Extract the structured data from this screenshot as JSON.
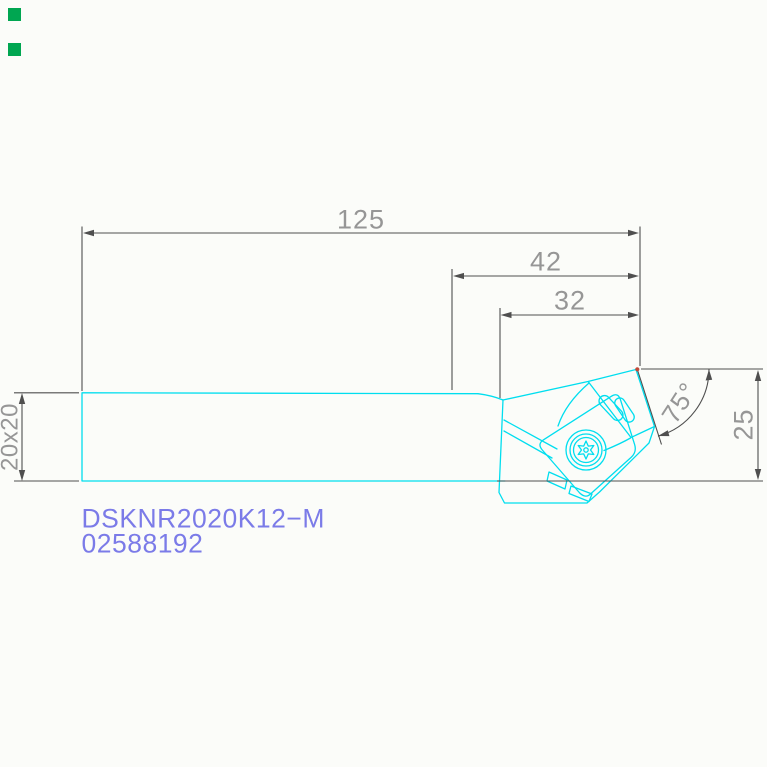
{
  "product": {
    "designation": "DSKNR2020K12−M",
    "order_number": "02588192"
  },
  "dimensions": {
    "overall_length": "125",
    "head_length": "42",
    "nose_offset": "32",
    "shank_section": "20x20",
    "head_height": "25",
    "entering_angle": "75°"
  },
  "colors": {
    "background": "#FBFCF9",
    "tool_cyan": "#00DEEF",
    "dim_line": "#4F4F4F",
    "dim_text": "#969696",
    "title_blue": "#7B7BE8",
    "marker_green": "#00A651",
    "corner_red": "#C04A3A"
  }
}
